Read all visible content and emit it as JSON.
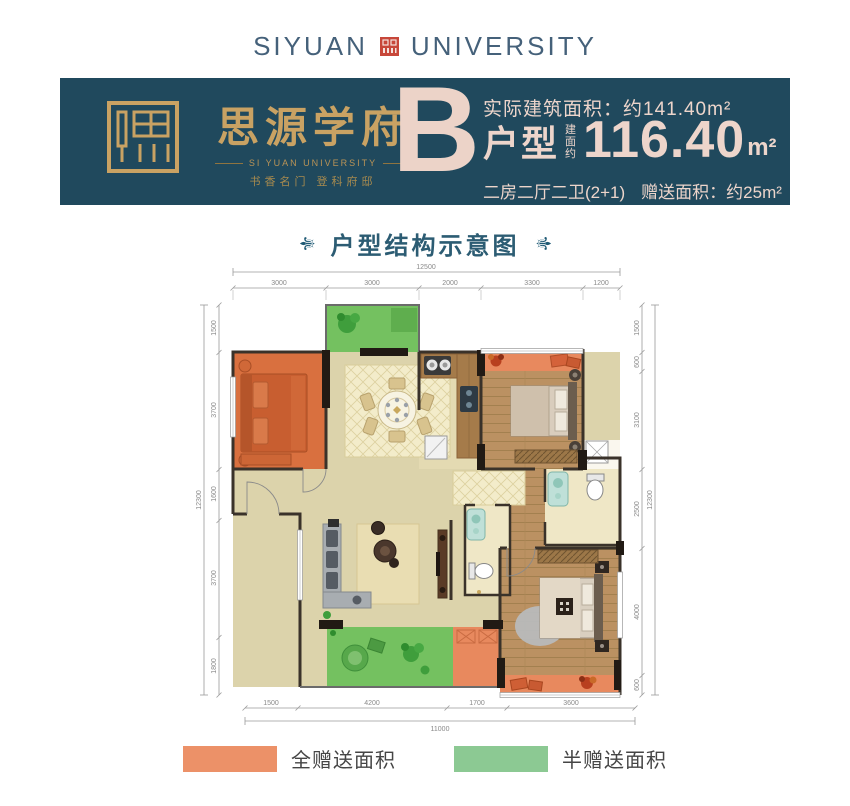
{
  "header": {
    "brand_left": "SIYUAN",
    "brand_right": "UNIVERSITY"
  },
  "banner": {
    "project_name": "思源学府",
    "project_sub": "SI YUAN UNIVERSITY",
    "project_slogan": "书香名门  登科府邸",
    "unit_letter": "B",
    "actual_area_label": "实际建筑面积：",
    "actual_area_value": "约141.40m²",
    "unit_type_label": "户型",
    "area_prefix": "建面约",
    "area_value": "116.40",
    "area_unit": "m²",
    "layout_desc": "二房二厅二卫(2+1)",
    "gift_area_label": "赠送面积：",
    "gift_area_value": "约25m²"
  },
  "section": {
    "title": "户型结构示意图",
    "ornament": "⚜"
  },
  "plan": {
    "dims": {
      "top_total": "12500",
      "top_segments": [
        "3000",
        "3000",
        "2000",
        "3300",
        "1200"
      ],
      "bottom_total": "11000",
      "bottom_segments": [
        "1500",
        "4200",
        "1700",
        "3600"
      ],
      "left_total": "12300",
      "left_segments": [
        "1500",
        "3700",
        "1600",
        "3700",
        "1800"
      ],
      "right_total": "12300",
      "right_segments": [
        "1500",
        "600",
        "3100",
        "2500",
        "4000",
        "600"
      ]
    }
  },
  "legend": {
    "full": {
      "label": "全赠送面积",
      "color": "#EC9168"
    },
    "half": {
      "label": "半赠送面积",
      "color": "#8CC993"
    }
  },
  "colors": {
    "banner_bg": "#20495D",
    "gold": "#C9A263",
    "pink_text": "#EDD5CB",
    "title_teal": "#2C5C73",
    "seal_red": "#C7473A",
    "wall_dark": "#3A322A",
    "floor_cream": "#DCD3AB",
    "wood": "#BB9162",
    "gift_orange": "#E8895E",
    "balcony_green": "#74C160"
  }
}
